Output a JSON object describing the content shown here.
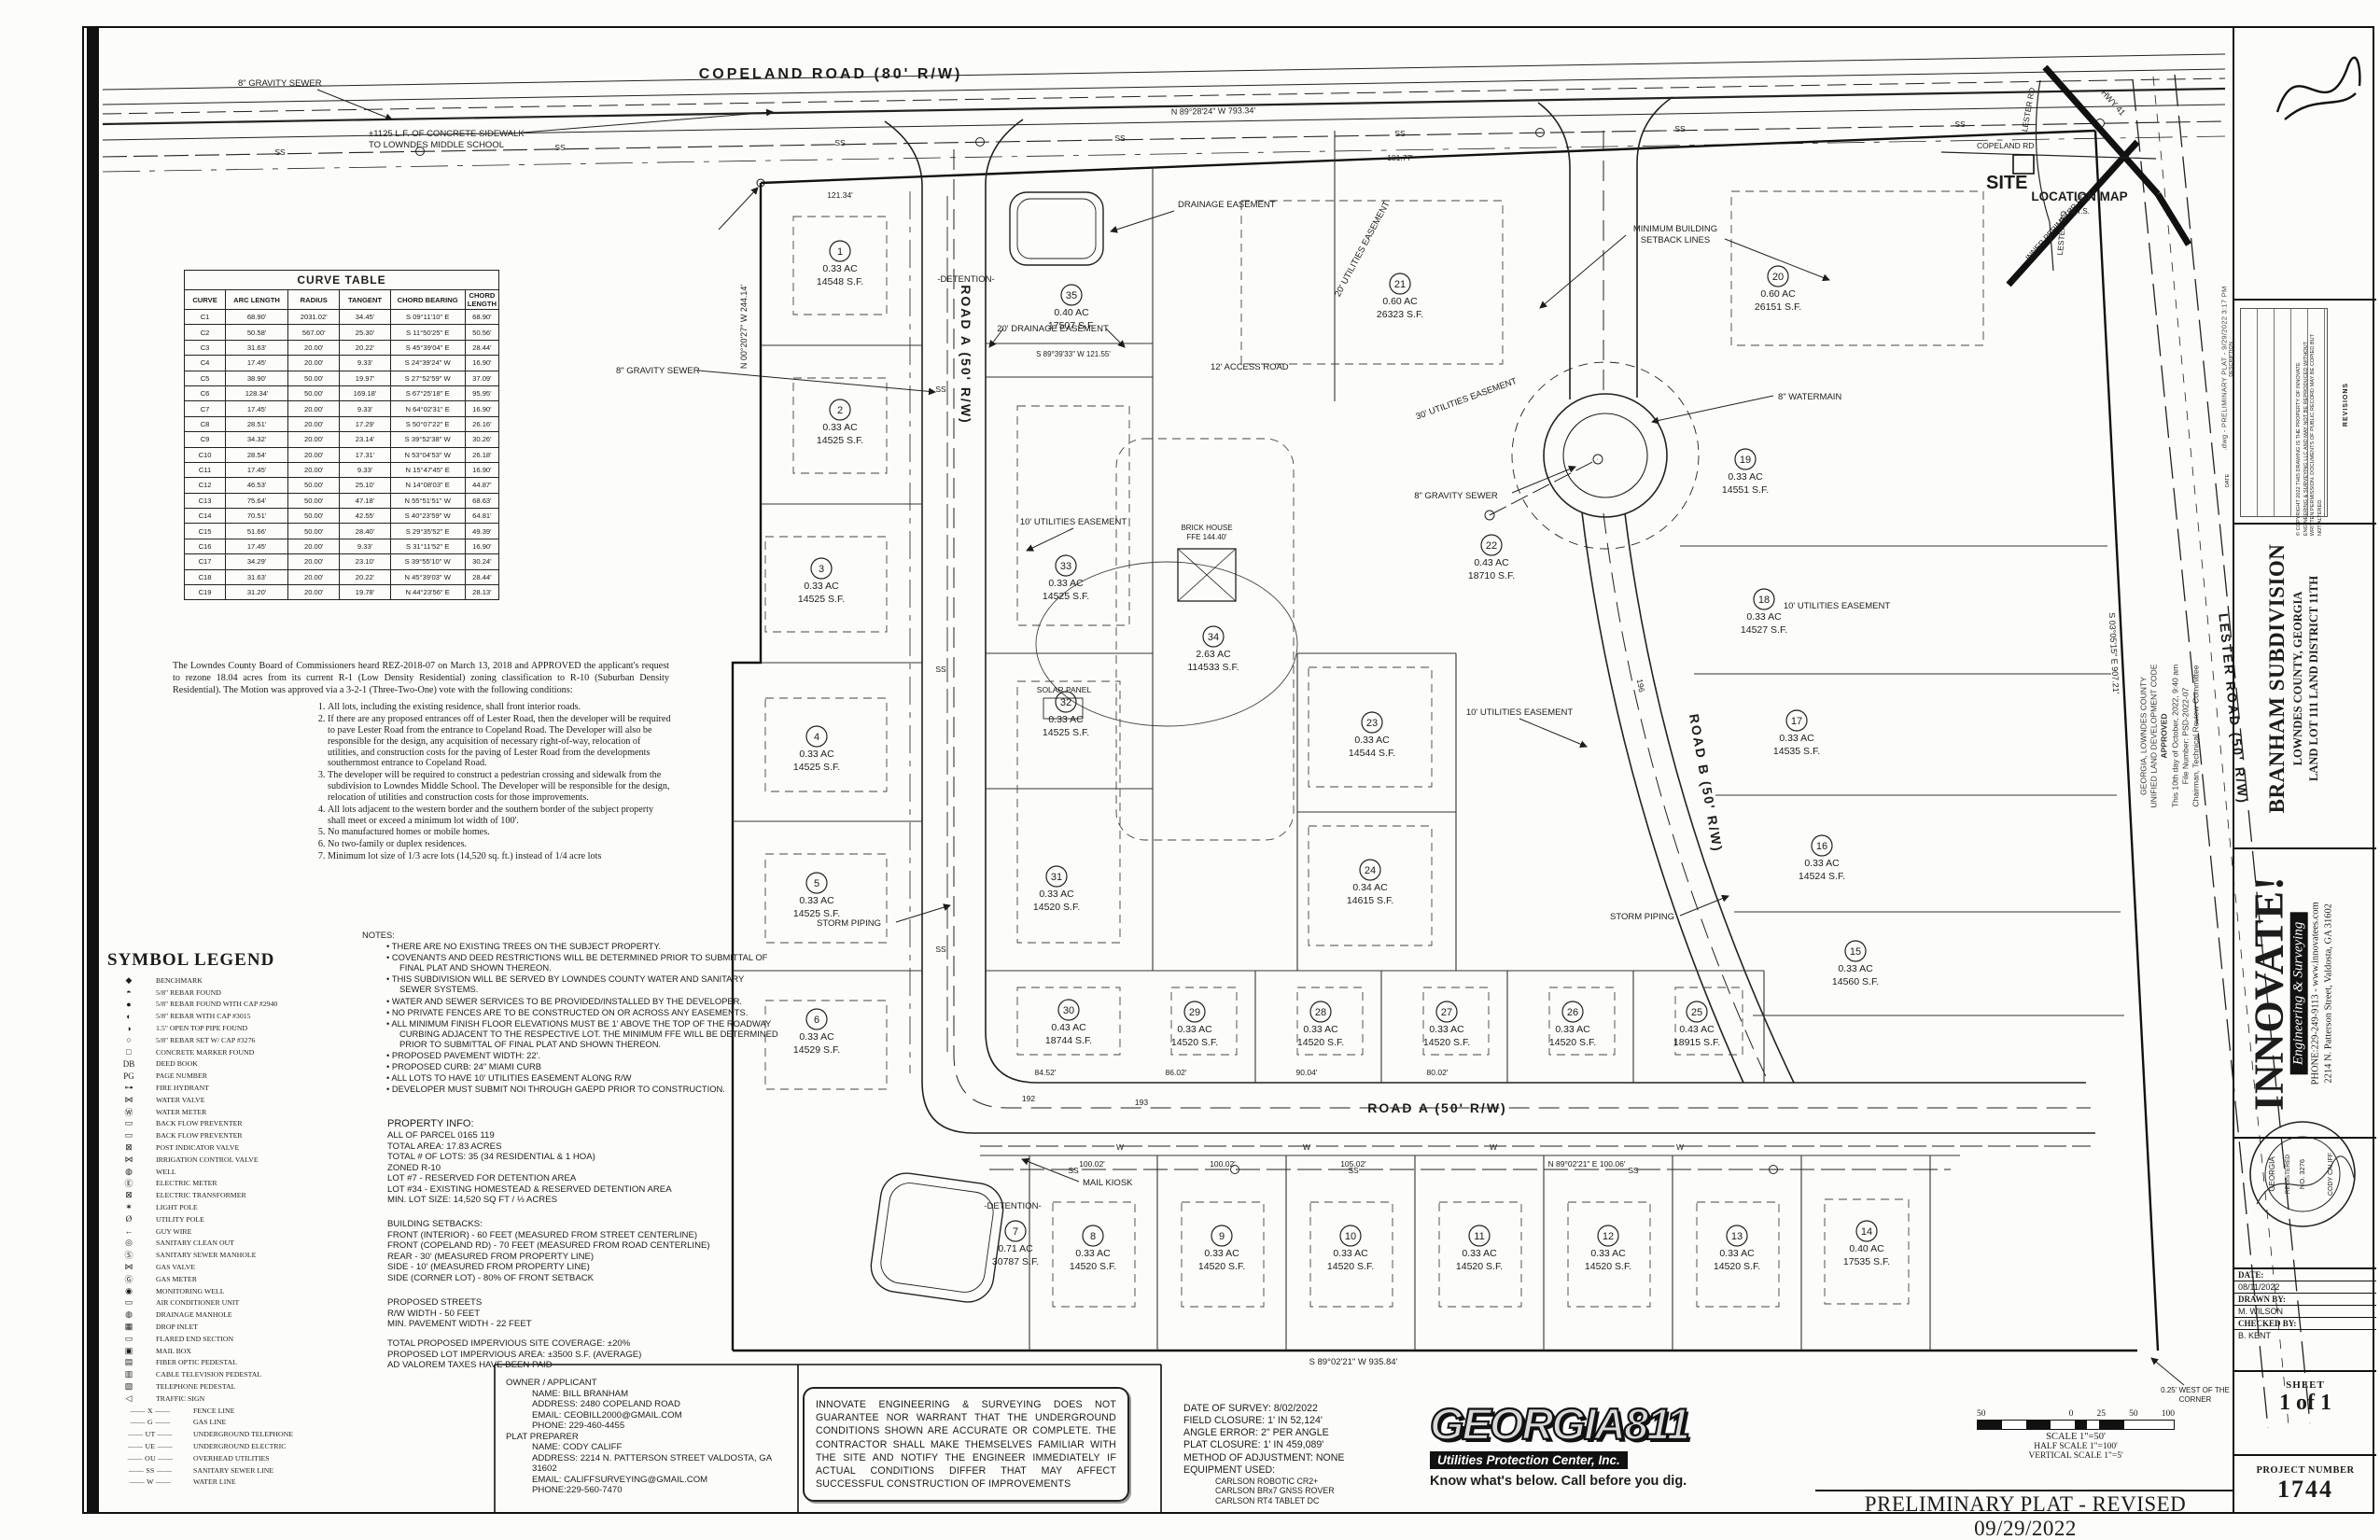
{
  "sheet": {
    "footer_title": "PRELIMINARY PLAT - REVISED 09/29/2022",
    "plot_stamp": ".dwg - PRELIMINARY PLAT - 9/29/2022 3:17 PM"
  },
  "curve_table": {
    "title": "CURVE TABLE",
    "headers": [
      "CURVE",
      "ARC LENGTH",
      "RADIUS",
      "TANGENT",
      "CHORD BEARING",
      "CHORD LENGTH"
    ],
    "rows": [
      {
        "c": "C1",
        "arc": "68.90'",
        "rad": "2031.02'",
        "tan": "34.45'",
        "cb": "S 09°11'10\" E",
        "cl": "68.90'"
      },
      {
        "c": "C2",
        "arc": "50.58'",
        "rad": "567.00'",
        "tan": "25.30'",
        "cb": "S 11°50'25\" E",
        "cl": "50.56'"
      },
      {
        "c": "C3",
        "arc": "31.63'",
        "rad": "20.00'",
        "tan": "20.22'",
        "cb": "S 45°39'04\" E",
        "cl": "28.44'"
      },
      {
        "c": "C4",
        "arc": "17.45'",
        "rad": "20.00'",
        "tan": "9.33'",
        "cb": "S 24°39'24\" W",
        "cl": "16.90'"
      },
      {
        "c": "C5",
        "arc": "38.90'",
        "rad": "50.00'",
        "tan": "19.97'",
        "cb": "S 27°52'59\" W",
        "cl": "37.09'"
      },
      {
        "c": "C6",
        "arc": "128.34'",
        "rad": "50.00'",
        "tan": "169.18'",
        "cb": "S 67°25'18\" E",
        "cl": "95.95'"
      },
      {
        "c": "C7",
        "arc": "17.45'",
        "rad": "20.00'",
        "tan": "9.33'",
        "cb": "N 64°02'31\" E",
        "cl": "16.90'"
      },
      {
        "c": "C8",
        "arc": "28.51'",
        "rad": "20.00'",
        "tan": "17.29'",
        "cb": "S 50°07'22\" E",
        "cl": "26.16'"
      },
      {
        "c": "C9",
        "arc": "34.32'",
        "rad": "20.00'",
        "tan": "23.14'",
        "cb": "S 39°52'38\" W",
        "cl": "30.26'"
      },
      {
        "c": "C10",
        "arc": "28.54'",
        "rad": "20.00'",
        "tan": "17.31'",
        "cb": "N 53°04'53\" W",
        "cl": "26.18'"
      },
      {
        "c": "C11",
        "arc": "17.45'",
        "rad": "20.00'",
        "tan": "9.33'",
        "cb": "N 15°47'45\" E",
        "cl": "16.90'"
      },
      {
        "c": "C12",
        "arc": "46.53'",
        "rad": "50.00'",
        "tan": "25.10'",
        "cb": "N 14°08'03\" E",
        "cl": "44.87'"
      },
      {
        "c": "C13",
        "arc": "75.64'",
        "rad": "50.00'",
        "tan": "47.18'",
        "cb": "N 55°51'51\" W",
        "cl": "68.63'"
      },
      {
        "c": "C14",
        "arc": "70.51'",
        "rad": "50.00'",
        "tan": "42.55'",
        "cb": "S 40°23'59\" W",
        "cl": "64.81'"
      },
      {
        "c": "C15",
        "arc": "51.66'",
        "rad": "50.00'",
        "tan": "28.40'",
        "cb": "S 29°35'52\" E",
        "cl": "49.39'"
      },
      {
        "c": "C16",
        "arc": "17.45'",
        "rad": "20.00'",
        "tan": "9.33'",
        "cb": "S 31°11'52\" E",
        "cl": "16.90'"
      },
      {
        "c": "C17",
        "arc": "34.29'",
        "rad": "20.00'",
        "tan": "23.10'",
        "cb": "S 39°55'10\" W",
        "cl": "30.24'"
      },
      {
        "c": "C18",
        "arc": "31.63'",
        "rad": "20.00'",
        "tan": "20.22'",
        "cb": "N 45°39'03\" W",
        "cl": "28.44'"
      },
      {
        "c": "C19",
        "arc": "31.20'",
        "rad": "20.00'",
        "tan": "19.78'",
        "cb": "N 44°23'56\" E",
        "cl": "28.13'"
      }
    ]
  },
  "rezoning": {
    "intro": "The Lowndes County Board of Commissioners heard REZ-2018-07 on March 13, 2018 and APPROVED the applicant's request to rezone 18.04 acres from its current R-1 (Low Density Residential) zoning classification to R-10 (Suburban Density Residential).  The Motion was approved via a 3-2-1 (Three-Two-One) vote with the following conditions:",
    "conditions": [
      {
        "t": "All lots, including the existing residence, shall front interior roads."
      },
      {
        "t": "If there are any proposed entrances off of Lester Road, then the developer will be required to pave Lester Road from the entrance to Copeland Road.  The Developer will also be responsible for the design, any acquisition of necessary right-of-way, relocation of utilities, and construction costs for the paving of Lester Road from the developments southernmost entrance to Copeland Road."
      },
      {
        "t": "The developer will be required to construct a pedestrian crossing and sidewalk from the subdivision to Lowndes Middle School.  The Developer will be responsible for the design, relocation of utilities and construction costs for those improvements."
      },
      {
        "t": "All lots adjacent to the western border and the southern border of the subject property shall meet or exceed a minimum lot width of 100'."
      },
      {
        "t": "No manufactured homes or mobile homes."
      },
      {
        "t": "No two-family or duplex residences."
      },
      {
        "t": "Minimum lot size of 1/3 acre lots (14,520 sq. ft.) instead of 1/4 acre lots"
      }
    ]
  },
  "legend": {
    "title": "SYMBOL LEGEND",
    "items": [
      {
        "sym": "◆",
        "label": "BENCHMARK"
      },
      {
        "sym": "◓",
        "label": "5/8\" REBAR FOUND"
      },
      {
        "sym": "●",
        "label": "5/8\" REBAR FOUND WITH CAP #2940"
      },
      {
        "sym": "◐",
        "label": "5/8\" REBAR WITH CAP #3015"
      },
      {
        "sym": "◑",
        "label": "1.5\" OPEN TOP PIPE FOUND"
      },
      {
        "sym": "○",
        "label": "5/8\" REBAR SET W/ CAP #3276"
      },
      {
        "sym": "□",
        "label": "CONCRETE MARKER FOUND"
      },
      {
        "sym": "DB",
        "label": "DEED BOOK"
      },
      {
        "sym": "PG",
        "label": "PAGE NUMBER"
      },
      {
        "sym": "⊶",
        "label": "FIRE HYDRANT"
      },
      {
        "sym": "⋈",
        "label": "WATER VALVE"
      },
      {
        "sym": "Ⓦ",
        "label": "WATER METER"
      },
      {
        "sym": "▭",
        "label": "BACK FLOW PREVENTER"
      },
      {
        "sym": "▭",
        "label": "BACK FLOW PREVENTER"
      },
      {
        "sym": "⊠",
        "label": "POST INDICATOR VALVE"
      },
      {
        "sym": "⋈",
        "label": "IRRIGATION CONTROL VALVE"
      },
      {
        "sym": "◍",
        "label": "WELL"
      },
      {
        "sym": "Ⓔ",
        "label": "ELECTRIC METER"
      },
      {
        "sym": "⊠",
        "label": "ELECTRIC TRANSFORMER"
      },
      {
        "sym": "✶",
        "label": "LIGHT POLE"
      },
      {
        "sym": "Ø",
        "label": "UTILITY POLE"
      },
      {
        "sym": "←",
        "label": "GUY WIRE"
      },
      {
        "sym": "◎",
        "label": "SANITARY CLEAN OUT"
      },
      {
        "sym": "Ⓢ",
        "label": "SANITARY SEWER MANHOLE"
      },
      {
        "sym": "⋈",
        "label": "GAS VALVE"
      },
      {
        "sym": "Ⓖ",
        "label": "GAS METER"
      },
      {
        "sym": "◉",
        "label": "MONITORING WELL"
      },
      {
        "sym": "▭",
        "label": "AIR CONDITIONER UNIT"
      },
      {
        "sym": "◍",
        "label": "DRAINAGE MANHOLE"
      },
      {
        "sym": "▦",
        "label": "DROP INLET"
      },
      {
        "sym": "▭",
        "label": "FLARED END SECTION"
      },
      {
        "sym": "▣",
        "label": "MAIL BOX"
      },
      {
        "sym": "▤",
        "label": "FIBER OPTIC PEDESTAL"
      },
      {
        "sym": "▥",
        "label": "CABLE TELEVISION PEDESTAL"
      },
      {
        "sym": "▧",
        "label": "TELEPHONE PEDESTAL"
      },
      {
        "sym": "◁",
        "label": "TRAFFIC SIGN"
      }
    ],
    "line_items": [
      {
        "tag": "——  X  ——",
        "label": "FENCE LINE"
      },
      {
        "tag": "——  G  ——",
        "label": "GAS LINE"
      },
      {
        "tag": "——  UT  ——",
        "label": "UNDERGROUND TELEPHONE"
      },
      {
        "tag": "——  UE  ——",
        "label": "UNDERGROUND ELECTRIC"
      },
      {
        "tag": "——  OU  ——",
        "label": "OVERHEAD UTILITIES"
      },
      {
        "tag": "——  SS  ——",
        "label": "SANITARY SEWER LINE"
      },
      {
        "tag": "——  W  ——",
        "label": "WATER LINE"
      }
    ]
  },
  "notes": {
    "title": "NOTES:",
    "items": [
      {
        "t": "THERE ARE NO EXISTING TREES ON THE SUBJECT PROPERTY."
      },
      {
        "t": "COVENANTS AND DEED RESTRICTIONS WILL BE DETERMINED PRIOR TO SUBMITTAL OF FINAL PLAT AND SHOWN THEREON."
      },
      {
        "t": "THIS SUBDIVISION WILL BE SERVED BY LOWNDES COUNTY WATER AND SANITARY SEWER SYSTEMS."
      },
      {
        "t": "WATER AND SEWER SERVICES TO BE PROVIDED/INSTALLED BY THE DEVELOPER."
      },
      {
        "t": "NO PRIVATE FENCES ARE TO BE CONSTRUCTED ON OR ACROSS ANY EASEMENTS."
      },
      {
        "t": "ALL MINIMUM FINISH FLOOR ELEVATIONS MUST BE 1' ABOVE THE TOP OF THE ROADWAY CURBING ADJACENT TO THE RESPECTIVE LOT.  THE MINIMUM FFE WILL BE DETERMINED PRIOR TO SUBMITTAL OF FINAL PLAT AND SHOWN THEREON."
      },
      {
        "t": "PROPOSED PAVEMENT WIDTH: 22'."
      },
      {
        "t": "PROPOSED CURB: 24\" MIAMI CURB"
      },
      {
        "t": "ALL LOTS TO HAVE 10' UTILITIES EASEMENT ALONG R/W"
      },
      {
        "t": "DEVELOPER MUST SUBMIT NOI THROUGH GAEPD PRIOR TO CONSTRUCTION."
      }
    ]
  },
  "property_info": {
    "title": "PROPERTY INFO:",
    "lines": [
      {
        "t": "ALL OF PARCEL 0165 119"
      },
      {
        "t": "TOTAL AREA: 17.83 ACRES"
      },
      {
        "t": "TOTAL # OF LOTS: 35 (34 RESIDENTIAL & 1 HOA)"
      },
      {
        "t": "ZONED R-10"
      },
      {
        "t": "LOT #7  - RESERVED FOR DETENTION AREA"
      },
      {
        "t": "LOT #34 - EXISTING HOMESTEAD & RESERVED DETENTION AREA"
      },
      {
        "t": "MIN. LOT SIZE: 14,520 SQ FT / ⅓ ACRES"
      }
    ]
  },
  "setbacks": {
    "title": "BUILDING SETBACKS:",
    "lines": [
      {
        "t": "FRONT (INTERIOR) - 60 FEET (MEASURED FROM STREET CENTERLINE)"
      },
      {
        "t": "FRONT  (COPELAND RD) - 70 FEET (MEASURED FROM ROAD CENTERLINE)"
      },
      {
        "t": "REAR - 30' (MEASURED FROM PROPERTY LINE)"
      },
      {
        "t": "SIDE - 10' (MEASURED FROM PROPERTY LINE)"
      },
      {
        "t": "SIDE (CORNER LOT) - 80% OF FRONT SETBACK"
      }
    ]
  },
  "streets": {
    "title": "PROPOSED STREETS",
    "lines": [
      {
        "t": "R/W WIDTH - 50 FEET"
      },
      {
        "t": "MIN. PAVEMENT WIDTH - 22 FEET"
      }
    ]
  },
  "impervious": {
    "lines": [
      {
        "t": "TOTAL PROPOSED IMPERVIOUS SITE COVERAGE: ±20%"
      },
      {
        "t": "PROPOSED LOT IMPERVIOUS AREA: ±3500 S.F.  (AVERAGE)"
      },
      {
        "t": "AD VALOREM TAXES HAVE BEEN PAID"
      }
    ]
  },
  "owner": {
    "title": "OWNER / APPLICANT",
    "lines": [
      {
        "t": "NAME: BILL BRANHAM"
      },
      {
        "t": "ADDRESS: 2480 COPELAND ROAD"
      },
      {
        "t": "EMAIL: CEOBILL2000@GMAIL.COM"
      },
      {
        "t": "PHONE: 229-460-4455"
      }
    ]
  },
  "preparer": {
    "title": "PLAT PREPARER",
    "lines": [
      {
        "t": "NAME: CODY CALIFF"
      },
      {
        "t": "ADDRESS: 2214 N. PATTERSON STREET VALDOSTA, GA 31602"
      },
      {
        "t": "EMAIL: CALIFFSURVEYING@GMAIL.COM"
      },
      {
        "t": "PHONE:229-560-7470"
      }
    ]
  },
  "disclaimer": "INNOVATE ENGINEERING & SURVEYING DOES NOT GUARANTEE NOR WARRANT THAT THE UNDERGROUND CONDITIONS SHOWN ARE ACCURATE OR COMPLETE. THE CONTRACTOR SHALL MAKE THEMSELVES FAMILIAR WITH THE SITE AND NOTIFY THE ENGINEER IMMEDIATELY IF ACTUAL CONDITIONS DIFFER THAT MAY AFFECT SUCCESSFUL CONSTRUCTION OF IMPROVEMENTS",
  "georgia811": {
    "logo": "GEORGIA811",
    "sub": "Utilities Protection Center, Inc.",
    "tagline": "Know what's below. Call before you dig."
  },
  "survey": {
    "lines": [
      {
        "t": "DATE OF SURVEY: 8/02/2022"
      },
      {
        "t": "FIELD CLOSURE: 1' IN 52,124'"
      },
      {
        "t": "ANGLE ERROR: 2\" PER ANGLE"
      },
      {
        "t": "PLAT CLOSURE: 1' IN 459,089'"
      },
      {
        "t": "METHOD OF ADJUSTMENT: NONE"
      },
      {
        "t": "EQUIPMENT USED:"
      }
    ],
    "equipment": [
      {
        "t": "CARLSON ROBOTIC CR2+"
      },
      {
        "t": "CARLSON BRx7 GNSS ROVER"
      },
      {
        "t": "CARLSON RT4 TABLET DC"
      }
    ]
  },
  "scalebar": {
    "ticks": [
      "50",
      "0",
      "25",
      "50",
      "100"
    ],
    "scale": "SCALE  1\"=50'",
    "half": "HALF SCALE  1\"=100'",
    "vertical": "VERTICAL SCALE  1\"=5'"
  },
  "location_map": {
    "title": "LOCATION MAP",
    "nts": "N.T.S.",
    "site": "SITE",
    "roads": {
      "copeland": "COPELAND RD",
      "lester_n": "LESTER RD",
      "lester_s": "LESTER RD",
      "hwy41": "HWY 41",
      "inner": "INNER PERIMETER RD"
    }
  },
  "titleblock": {
    "project": {
      "name": "BRANHAM SUBDIVISION",
      "county": "LOWNDES COUNTY, GEORGIA",
      "landlot": "LAND LOT 111 LAND DISTRICT 11TH"
    },
    "firm": {
      "name": "INNOVATE!",
      "division": "Engineering & Surveying",
      "phone": "PHONE:229-249-9113 - www.innovatees.com",
      "address": "2214 N. Patterson Street, Valdosta, GA 31602"
    },
    "seal": {
      "l1": "GEORGIA",
      "l2": "REGISTERED",
      "l3": "NO. 3276",
      "l4": "CODY CALIFF"
    },
    "revisions": {
      "title": "REVISIONS",
      "date": "DATE",
      "desc": "DESCRIPTION"
    },
    "copyright": "© COPYRIGHT 2022  THIS DRAWING IS THE PROPERTY OF INNOVATE ENGINEERING & SURVEYING LLC AND MAY NOT BE REPRODUCED WITHOUT WRITTEN PERMISSION.  DOCUMENTS OF PUBLIC RECORD MAY BE COPIED BUT NOT ALTERED.",
    "date_label": "DATE:",
    "date": "08/11/2022",
    "drawn_label": "DRAWN BY:",
    "drawn": "M. WILSON",
    "checked_label": "CHECKED BY:",
    "checked": "B. KENT",
    "sheet_label": "SHEET",
    "sheet": "1 of 1",
    "project_label": "PROJECT NUMBER",
    "project_number": "1744"
  },
  "approval": {
    "l1": "GEORGIA, LOWNDES COUNTY",
    "l2": "UNIFIED LAND DEVELOPMENT CODE",
    "l3": "APPROVED",
    "l4": "This 10th day of October, 2022, 9:40 am",
    "l5": "File Number: PSD-2022-07",
    "l6": "Chairman, Technical Review Committee"
  },
  "plat": {
    "labels": {
      "copeland": "COPELAND ROAD (80' R/W)",
      "road_a": "ROAD A (50' R/W)",
      "road_b": "ROAD B (50' R/W)",
      "lester": "LESTER ROAD (50' R/W)",
      "sidewalk1": "±1125 L.F. OF CONCRETE SIDEWALK",
      "sidewalk2": "TO LOWNDES MIDDLE SCHOOL",
      "gravity_sewer": "8\" GRAVITY SEWER",
      "watermain": "8\" WATERMAIN",
      "storm": "STORM PIPING",
      "detention": "-DETENTION-",
      "drainage_easement": "DRAINAGE EASEMENT",
      "drainage20": "20' DRAINAGE EASEMENT",
      "access12": "12' ACCESS ROAD",
      "ue10": "10' UTILITIES EASEMENT",
      "ue20": "20' UTILITIES EASEMENT",
      "ue30": "30' UTILITIES EASEMENT",
      "minbsl1": "MINIMUM BUILDING",
      "minbsl2": "SETBACK LINES",
      "mail": "MAIL KIOSK",
      "solar": "SOLAR PANEL",
      "brick1": "BRICK HOUSE",
      "brick2": "FFE 144.40'",
      "corner1": "0.25' WEST OF THE",
      "corner2": "CORNER",
      "ss": "SS",
      "w": "W"
    },
    "bearings": {
      "top": "N 89°28'24\" W  793.34'",
      "bottom": "S 89°02'21\" W  935.84'",
      "west": "N 00°20'27\" W  244.14'",
      "east": "S 03°05'15\" E  907.21'",
      "lot35": "S 89°39'33\" W  121.55'",
      "rowa": "N 89°02'21\" E  100.06'"
    },
    "dims": {
      "d1": "121.34'",
      "d2": "101.77'",
      "d3": "84.52'",
      "d4": "86.02'",
      "d5": "90.04'",
      "d6": "80.02'",
      "d7": "100.02'",
      "d8": "100.02'",
      "d9": "105.02'",
      "d10": "192",
      "d11": "193",
      "d12": "196"
    },
    "lots": [
      {
        "num": "1",
        "acres": "0.33 AC",
        "sf": "14548 S.F."
      },
      {
        "num": "2",
        "acres": "0.33 AC",
        "sf": "14525 S.F."
      },
      {
        "num": "3",
        "acres": "0.33 AC",
        "sf": "14525 S.F."
      },
      {
        "num": "4",
        "acres": "0.33 AC",
        "sf": "14525 S.F."
      },
      {
        "num": "5",
        "acres": "0.33 AC",
        "sf": "14525 S.F."
      },
      {
        "num": "6",
        "acres": "0.33 AC",
        "sf": "14529 S.F."
      },
      {
        "num": "7",
        "acres": "0.71 AC",
        "sf": "30787 S.F."
      },
      {
        "num": "8",
        "acres": "0.33 AC",
        "sf": "14520 S.F."
      },
      {
        "num": "9",
        "acres": "0.33 AC",
        "sf": "14520 S.F."
      },
      {
        "num": "10",
        "acres": "0.33 AC",
        "sf": "14520 S.F."
      },
      {
        "num": "11",
        "acres": "0.33 AC",
        "sf": "14520 S.F."
      },
      {
        "num": "12",
        "acres": "0.33 AC",
        "sf": "14520 S.F."
      },
      {
        "num": "13",
        "acres": "0.33 AC",
        "sf": "14520 S.F."
      },
      {
        "num": "14",
        "acres": "0.40 AC",
        "sf": "17535 S.F."
      },
      {
        "num": "15",
        "acres": "0.33 AC",
        "sf": "14560 S.F."
      },
      {
        "num": "16",
        "acres": "0.33 AC",
        "sf": "14524 S.F."
      },
      {
        "num": "17",
        "acres": "0.33 AC",
        "sf": "14535 S.F."
      },
      {
        "num": "18",
        "acres": "0.33 AC",
        "sf": "14527 S.F."
      },
      {
        "num": "19",
        "acres": "0.33 AC",
        "sf": "14551 S.F."
      },
      {
        "num": "20",
        "acres": "0.60 AC",
        "sf": "26151 S.F."
      },
      {
        "num": "21",
        "acres": "0.60 AC",
        "sf": "26323 S.F."
      },
      {
        "num": "22",
        "acres": "0.43 AC",
        "sf": "18710 S.F."
      },
      {
        "num": "23",
        "acres": "0.33 AC",
        "sf": "14544 S.F."
      },
      {
        "num": "24",
        "acres": "0.34 AC",
        "sf": "14615 S.F."
      },
      {
        "num": "25",
        "acres": "0.43 AC",
        "sf": "18915 S.F."
      },
      {
        "num": "26",
        "acres": "0.33 AC",
        "sf": "14520 S.F."
      },
      {
        "num": "27",
        "acres": "0.33 AC",
        "sf": "14520 S.F."
      },
      {
        "num": "28",
        "acres": "0.33 AC",
        "sf": "14520 S.F."
      },
      {
        "num": "29",
        "acres": "0.33 AC",
        "sf": "14520 S.F."
      },
      {
        "num": "30",
        "acres": "0.43 AC",
        "sf": "18744 S.F."
      },
      {
        "num": "31",
        "acres": "0.33 AC",
        "sf": "14520 S.F."
      },
      {
        "num": "32",
        "acres": "0.33 AC",
        "sf": "14525 S.F."
      },
      {
        "num": "33",
        "acres": "0.33 AC",
        "sf": "14525 S.F."
      },
      {
        "num": "34",
        "acres": "2.63 AC",
        "sf": "114533 S.F."
      },
      {
        "num": "35",
        "acres": "0.40 AC",
        "sf": "17507 S.F."
      }
    ]
  }
}
